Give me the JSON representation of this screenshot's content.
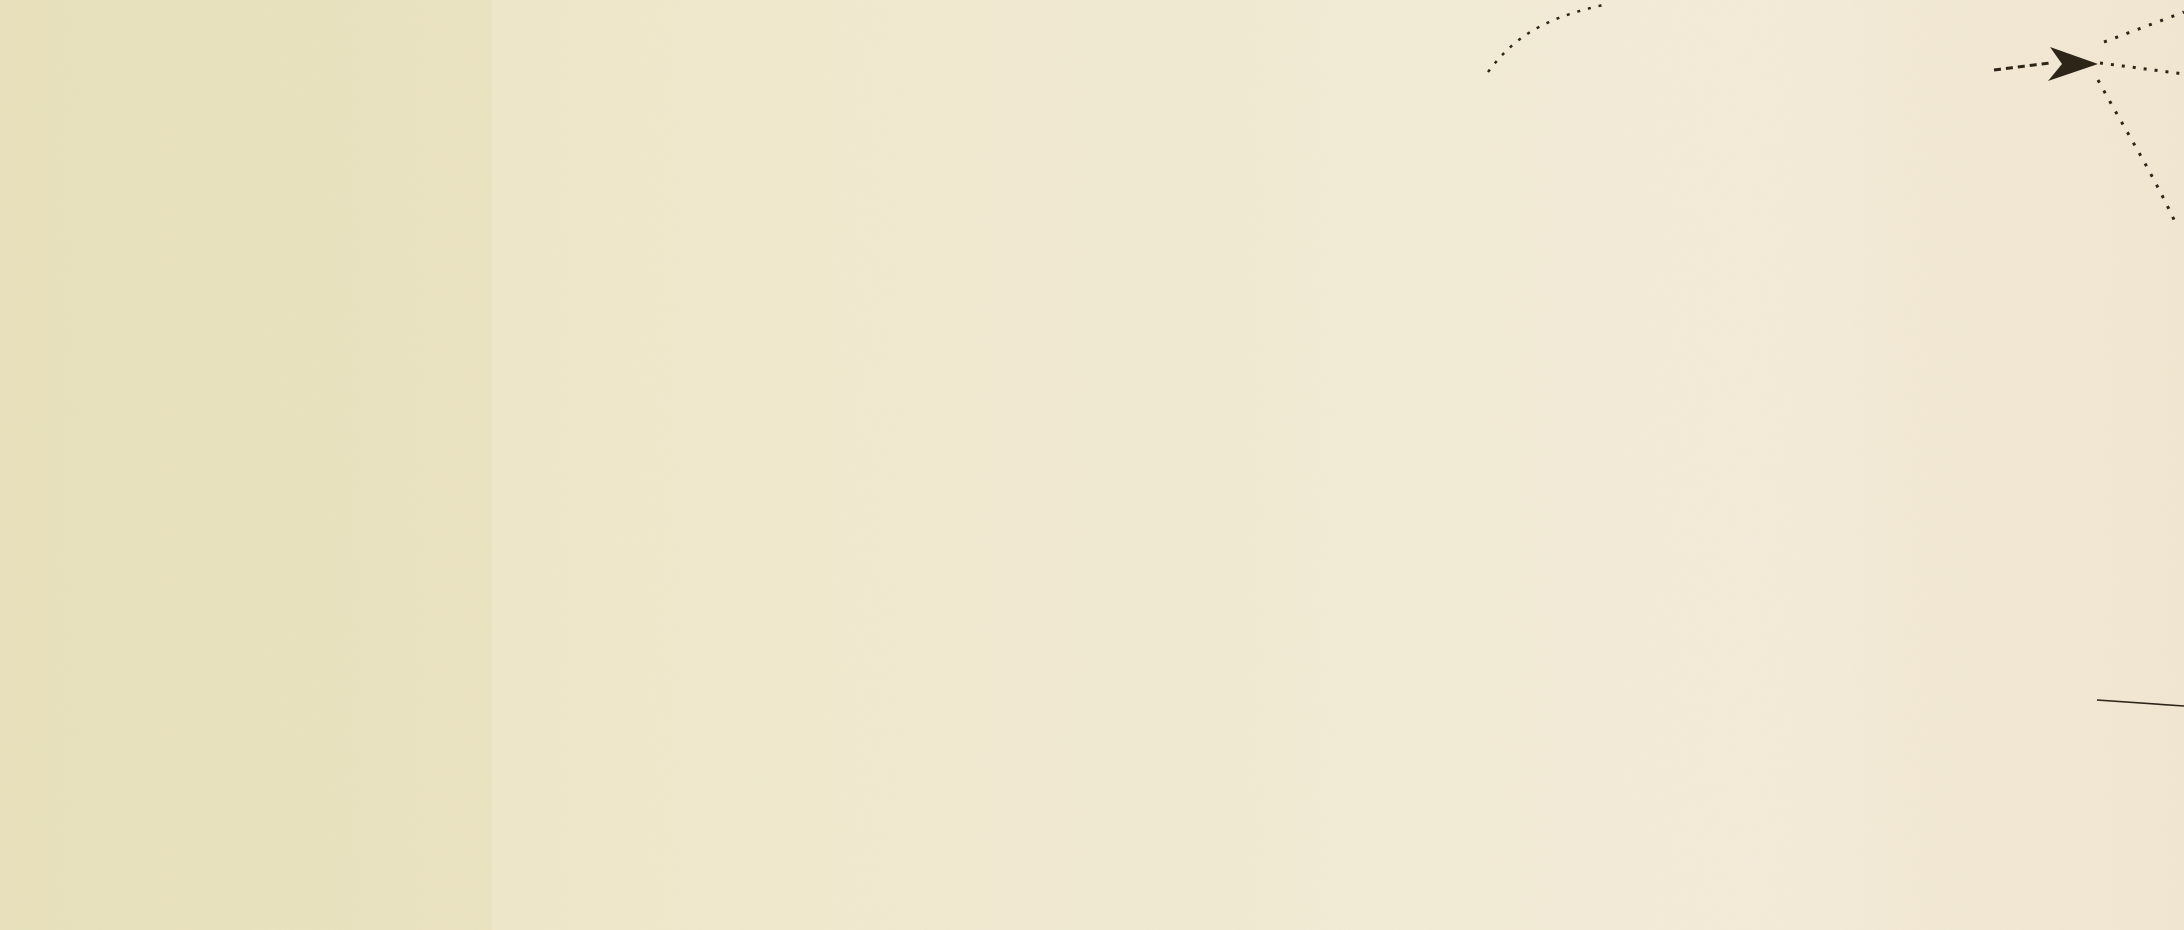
{
  "map": {
    "title": "GUIBEVILLE",
    "neighbor_town_label": "uinville.",
    "avenue_note": "Mont",
    "road_note": "Longs",
    "measurements": {
      "outer": "219-10",
      "inner": "278-",
      "diagonal": "78.30",
      "road": "43.",
      "bearing": "50",
      "crossing": "40",
      "distance": "200."
    },
    "icons": {
      "north_arrow": "direction-arrow-icon"
    },
    "colors": {
      "paper": "#efe8cb",
      "paper_left": "#e8e1bb",
      "paper_right": "#f4ebd8",
      "ink": "#2e2519",
      "boundary_red": "#9e2f2a",
      "tree_green": "#2c681d",
      "garden_green": "#aac56c",
      "garden_green_dark": "#6f9b3f",
      "road_wash": "#c8535f",
      "building_pink": "#e6bab0",
      "building_outline": "#9c3026",
      "hedge_green": "#4e8a35",
      "path_cream": "#f2ead0",
      "path_edge": "#6b5b3c"
    }
  }
}
